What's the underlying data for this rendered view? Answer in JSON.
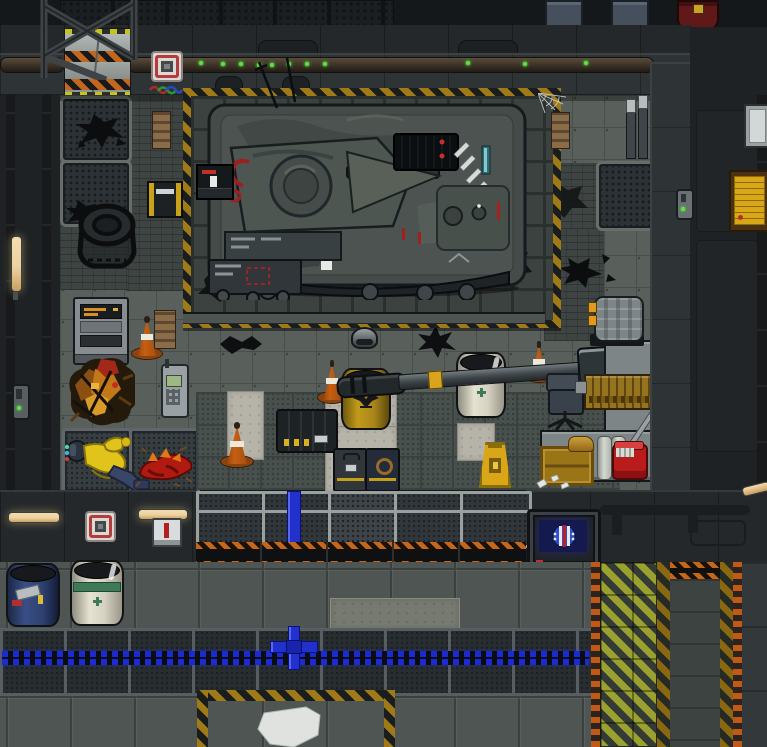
{
  "meta": {
    "title": "Space-station garage — top-down pixel game scene",
    "view": "top-down tile map",
    "tile_px": 32
  },
  "colors": {
    "floor": "#59605b",
    "floor_line": "#484f4b",
    "floor_dark": "#47504d",
    "brick": "#3e4441",
    "marble": "#b6b4a9",
    "plat_tile": "#3b4240",
    "plat_gap": "#2a302e",
    "wall": "#2e3335",
    "wall_dark": "#24282a",
    "ext": "#1e2224",
    "ext_top": "#15181a",
    "haz_gold": "#a07a16",
    "haz_black": "#191d1e",
    "orange_dash": "#c25a16",
    "lane_yellow": "#9aa12e",
    "lane_dark": "#343b36",
    "stripe_brown": "#8a6812",
    "shutter_orange": "#c4671c",
    "led_blue": "#1c2ad4",
    "ledBlue": "#1c2ad4",
    "pipe_blue": "#2230cc",
    "cone": "#c65f12",
    "drum_yellow": "#bd9318",
    "drum_white": "#e2decd",
    "drum_blue": "#31457c",
    "green_band": "#3e7a58",
    "wood": "#9a7518",
    "counter": "#7e8587",
    "metal_light": "#9aa09e",
    "screen": "#141a4e",
    "alarm_red": "#b43c3c",
    "led_green": "#66dd44",
    "tube_warm": "#ecd2a0",
    "sign_yellow": "#d8a616",
    "suit_yellow": "#d8c020",
    "blood_red": "#a81812"
  },
  "scene": {
    "regions": [
      "exterior corridor",
      "vehicle maintenance bay",
      "hazard-striped tank platform",
      "tool area",
      "delivery lane",
      "shuttered south wall"
    ],
    "objects": {
      "tank": {
        "label": "armored tank on maintenance platform"
      },
      "console": {
        "label": "platform control console"
      },
      "charger": {
        "label": "cell charger"
      },
      "vending": {
        "label": "parts vending machine"
      },
      "wreck": {
        "label": "burnt machine wreckage"
      },
      "hardsuit": {
        "label": "discarded yellow hardsuit"
      },
      "corpse": {
        "label": "dead creature remains"
      },
      "phone": {
        "label": "handheld radio"
      },
      "cone": {
        "label": "traffic cone"
      },
      "planks": {
        "label": "stack of wooden planks"
      },
      "fuel_drum": {
        "label": "yellow fuel drum"
      },
      "chem_drum": {
        "label": "white chemical drum"
      },
      "blue_drum": {
        "label": "blue storage drum"
      },
      "cannon": {
        "label": "dismounted tank cannon"
      },
      "ammo_crate": {
        "label": "ammunition crate"
      },
      "toolbox_gray": {
        "label": "gray toolbox"
      },
      "toolbox_blue": {
        "label": "blue toolbox"
      },
      "wet_sign": {
        "label": "wet floor sign"
      },
      "workbench": {
        "label": "wooden workbench"
      },
      "chair": {
        "label": "office chair"
      },
      "counter": {
        "label": "metal counter"
      },
      "pump": {
        "label": "portable pump unit"
      },
      "crate": {
        "label": "wooden crate"
      },
      "canisters": {
        "label": "metal canisters"
      },
      "bucket": {
        "label": "mop bucket"
      },
      "monitor": {
        "label": "station status monitor"
      },
      "air_alarm": {
        "label": "air alarm"
      },
      "intercom": {
        "label": "intercom"
      },
      "light_tube": {
        "label": "light fixture"
      },
      "access_button": {
        "label": "access button"
      },
      "wall_locker": {
        "label": "wall locker"
      },
      "red_canister": {
        "label": "fuel canister"
      },
      "notice": {
        "label": "posted notice"
      },
      "hatch": {
        "label": "wall hatch"
      },
      "blast_door": {
        "label": "blast door"
      },
      "shutters": {
        "label": "closed blast shutters"
      },
      "window": {
        "label": "reinforced window"
      },
      "mine": {
        "label": "dome helmet"
      },
      "tire": {
        "label": "loose vehicle wheel"
      },
      "blue_pipe": {
        "label": "blue supply pipe"
      },
      "sheet": {
        "label": "spilled white sheet"
      },
      "tiles_light": {
        "label": "marble tile path"
      }
    }
  }
}
